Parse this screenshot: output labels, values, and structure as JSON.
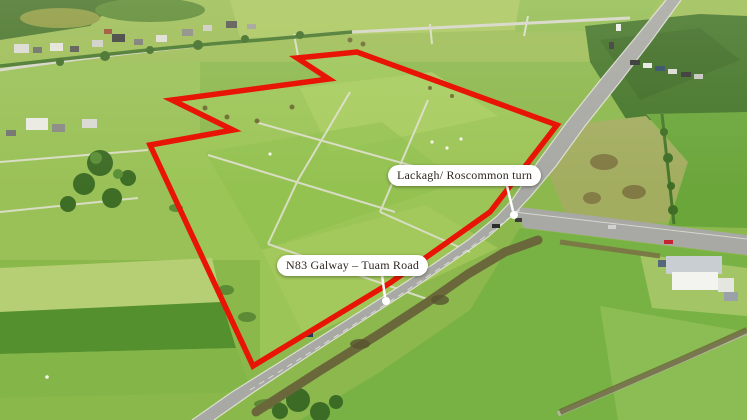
{
  "canvas": {
    "width": 747,
    "height": 420
  },
  "scene": {
    "kind": "aerial-drone-photograph",
    "summary": "Green farmland with a red outlined sale parcel beside the N83 road and the Lackagh/Roscommon junction"
  },
  "annotations": {
    "boundary_color": "#e81507",
    "label_background": "#ffffff",
    "label_text_color": "#2f2721",
    "labels": [
      {
        "id": "junction",
        "text": "Lackagh/ Roscommon turn"
      },
      {
        "id": "road",
        "text": "N83 Galway – Tuam Road"
      }
    ]
  }
}
